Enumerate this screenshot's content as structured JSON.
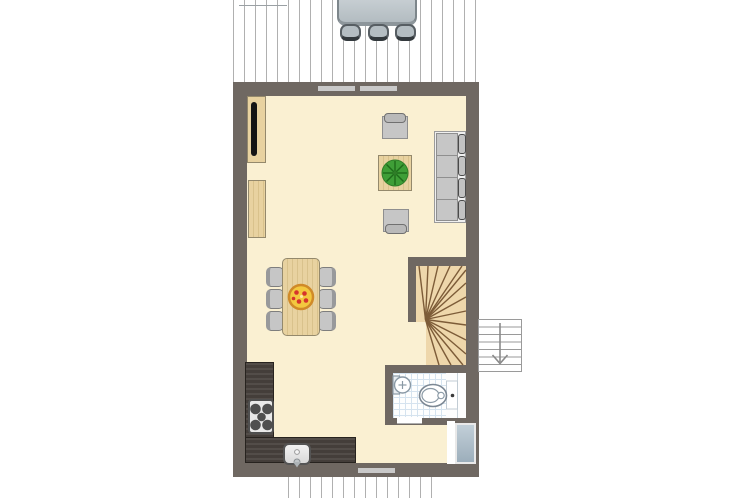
{
  "title": "apartment-floor-plan",
  "colors": {
    "background": "#ffffff",
    "wall": "#6f6862",
    "floor": "#faf0d2",
    "window": "#c9c9c9",
    "deck_line": "#b0b0b0",
    "wood": "#e8d2a0",
    "wood_grain": "#d9c28c",
    "wood_border": "#94896c",
    "stair_wood": "#eed7ab",
    "stair_tread": "#7d5c38",
    "gray_furniture": "#c6c6c6",
    "gray_furniture_border": "#8f8f8f",
    "outdoor_gray": "#b4bdc2",
    "counter": "#443e3a",
    "appliance_white": "#e9e9e9",
    "burner": "#4f4f4f",
    "tile_line": "#d5e3ef",
    "fixture_outline": "#7c8894",
    "door_panel_top": "#c2cfd8",
    "door_panel_bottom": "#9caebb",
    "plant_green": "#3f9e37",
    "plant_dark": "#1e6b1a",
    "pizza_base": "#f3c83f",
    "pizza_crust": "#d08a28",
    "pizza_topping": "#d6342c",
    "arrow": "#8a8a8a"
  },
  "elements": [
    "terrace-deck-top",
    "deck-edge",
    "outdoor-table",
    "outdoor-chair-1",
    "outdoor-chair-2",
    "outdoor-chair-3",
    "exterior-wall",
    "window-top-left",
    "window-top-right",
    "window-bottom",
    "living-room-floor",
    "tv-cabinet",
    "tv-screen",
    "sideboard",
    "sofa",
    "sofa-back-cushions",
    "armchair-top",
    "armchair-bottom",
    "coffee-table",
    "potted-plant",
    "dining-table",
    "dining-chairs",
    "pizza",
    "winder-staircase",
    "stair-treads",
    "external-staircase",
    "stair-down-arrow",
    "bathroom",
    "toilet",
    "washbasin",
    "bathroom-door",
    "kitchen-counter",
    "stove",
    "stove-burners",
    "kitchen-sink",
    "faucet",
    "entrance-door",
    "terrace-deck-bottom"
  ]
}
